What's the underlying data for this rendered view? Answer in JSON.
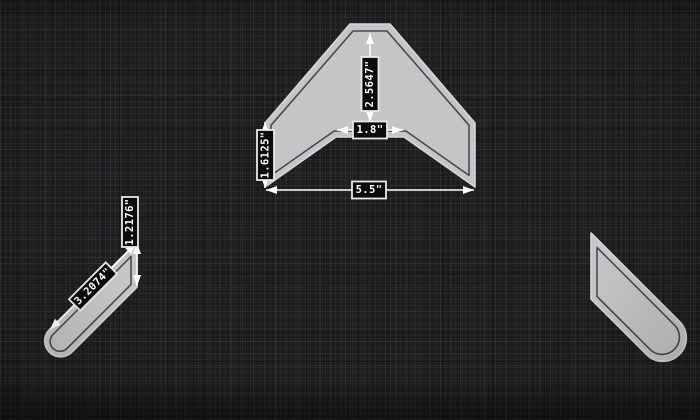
{
  "canvas": {
    "background_color": "#1d1e1f",
    "part_fill_color": "#c5c5c7",
    "part_edge_color": "#d6d6d8",
    "cut_line_color": "#4a4a4e",
    "dimension_color": "#ffffff",
    "label_bg_color": "#0b0b0b",
    "label_border_color": "#e9e9e9"
  },
  "parts": {
    "chevron": {
      "dimensions": {
        "apex_height": "2.5647\"",
        "notch_width": "1.8\"",
        "end_height": "1.6125\"",
        "overall_width": "5.5\""
      }
    },
    "left_arm": {
      "dimensions": {
        "edge_length": "3.2074\"",
        "end_height": "1.2176\""
      }
    },
    "right_arm": {
      "dimensions": {}
    }
  }
}
